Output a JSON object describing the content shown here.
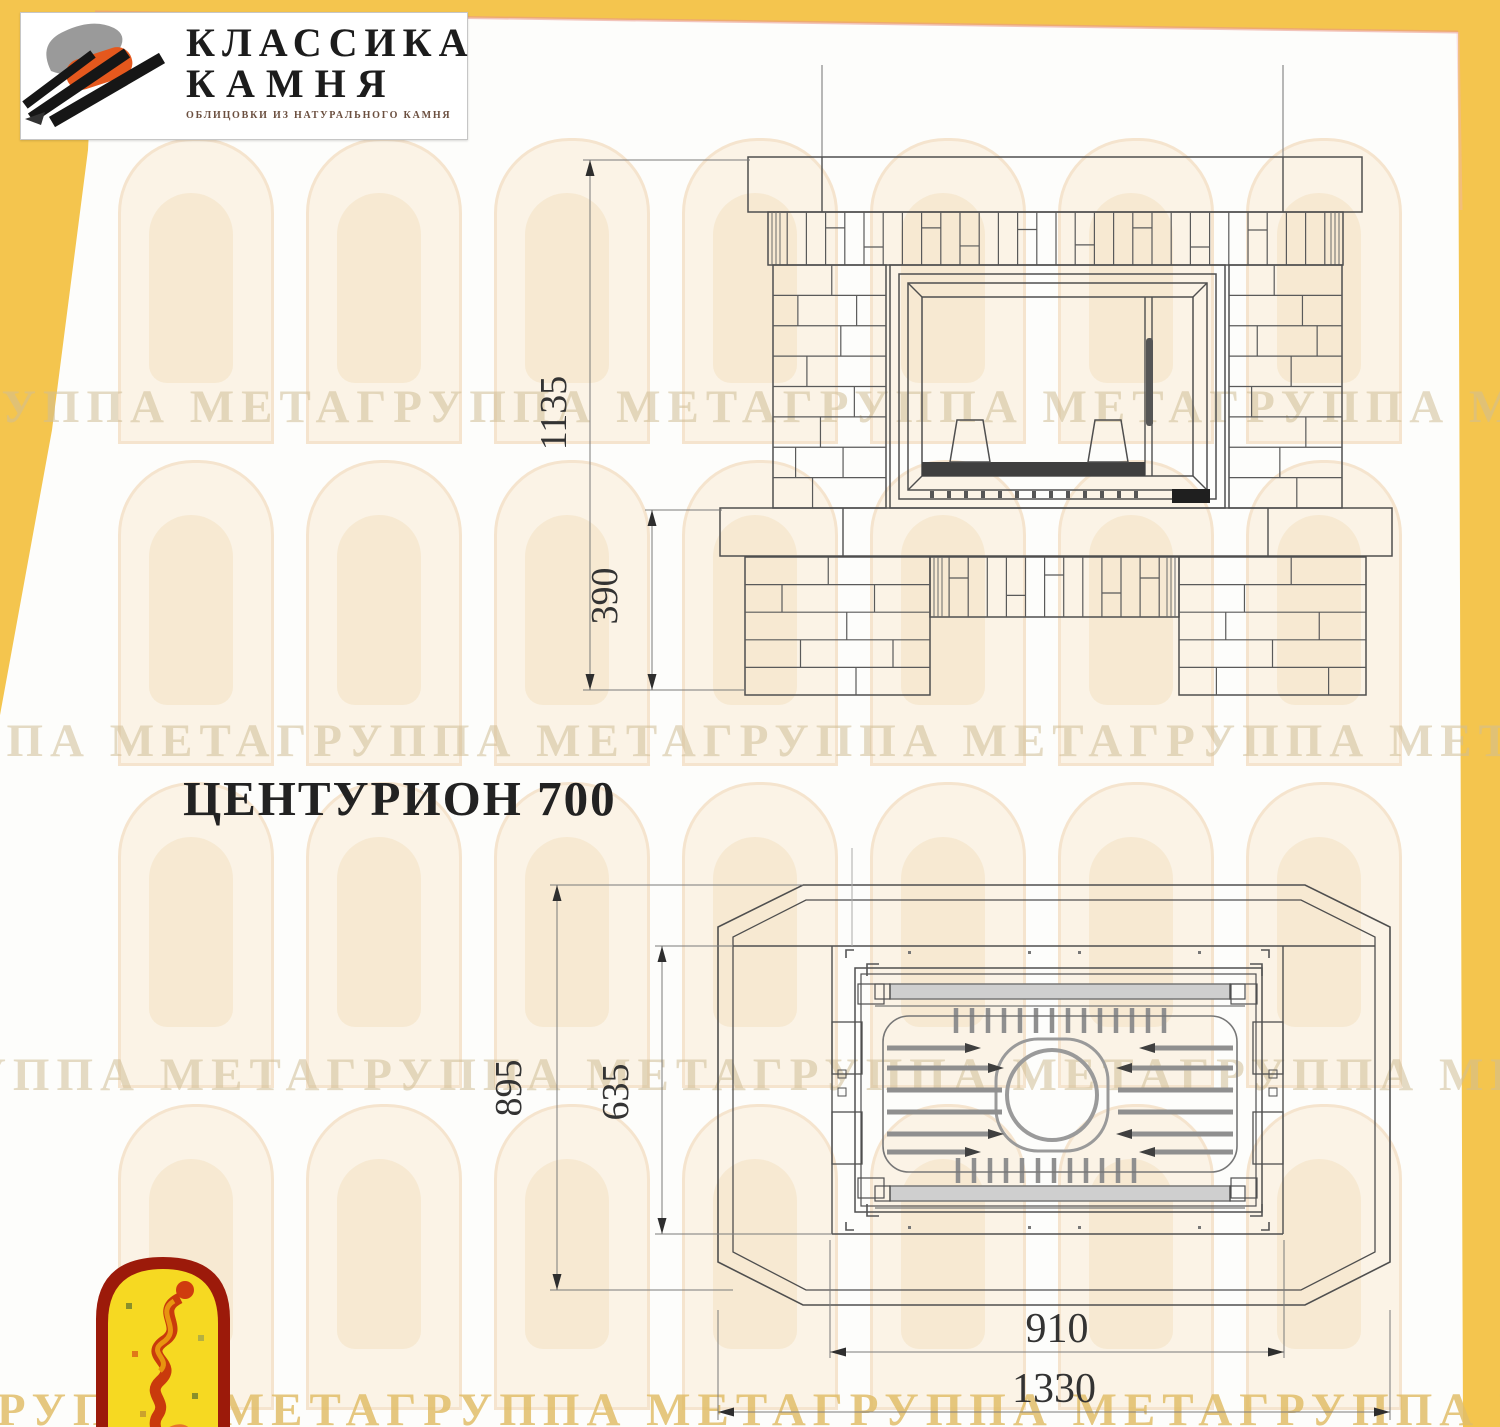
{
  "colors": {
    "background": "#f4c54e",
    "logo_orange": "#e5581d",
    "arch_red": "#9c1a0a",
    "arch_yellow": "#f6d922",
    "line": "#4f4f4f"
  },
  "header_logo": {
    "name_line1": "КЛАССИКА",
    "name_line2": "КАМНЯ",
    "tagline": "ОБЛИЦОВКИ ИЗ НАТУРАЛЬНОГО КАМНЯ"
  },
  "model": {
    "title": "ЦЕНТУРИОН 700"
  },
  "watermark": {
    "band_text": "ГРУППА МЕТАГРУППА МЕТАГРУППА МЕТАГРУППА МЕТАГРУППА МЕТА"
  },
  "drawing": {
    "front_view": {
      "dim_total_height": "1135",
      "dim_plinth_height": "390"
    },
    "top_view": {
      "dim_total_depth": "895",
      "dim_firebox_depth": "635",
      "dim_firebox_width": "910",
      "dim_total_width": "1330"
    }
  }
}
